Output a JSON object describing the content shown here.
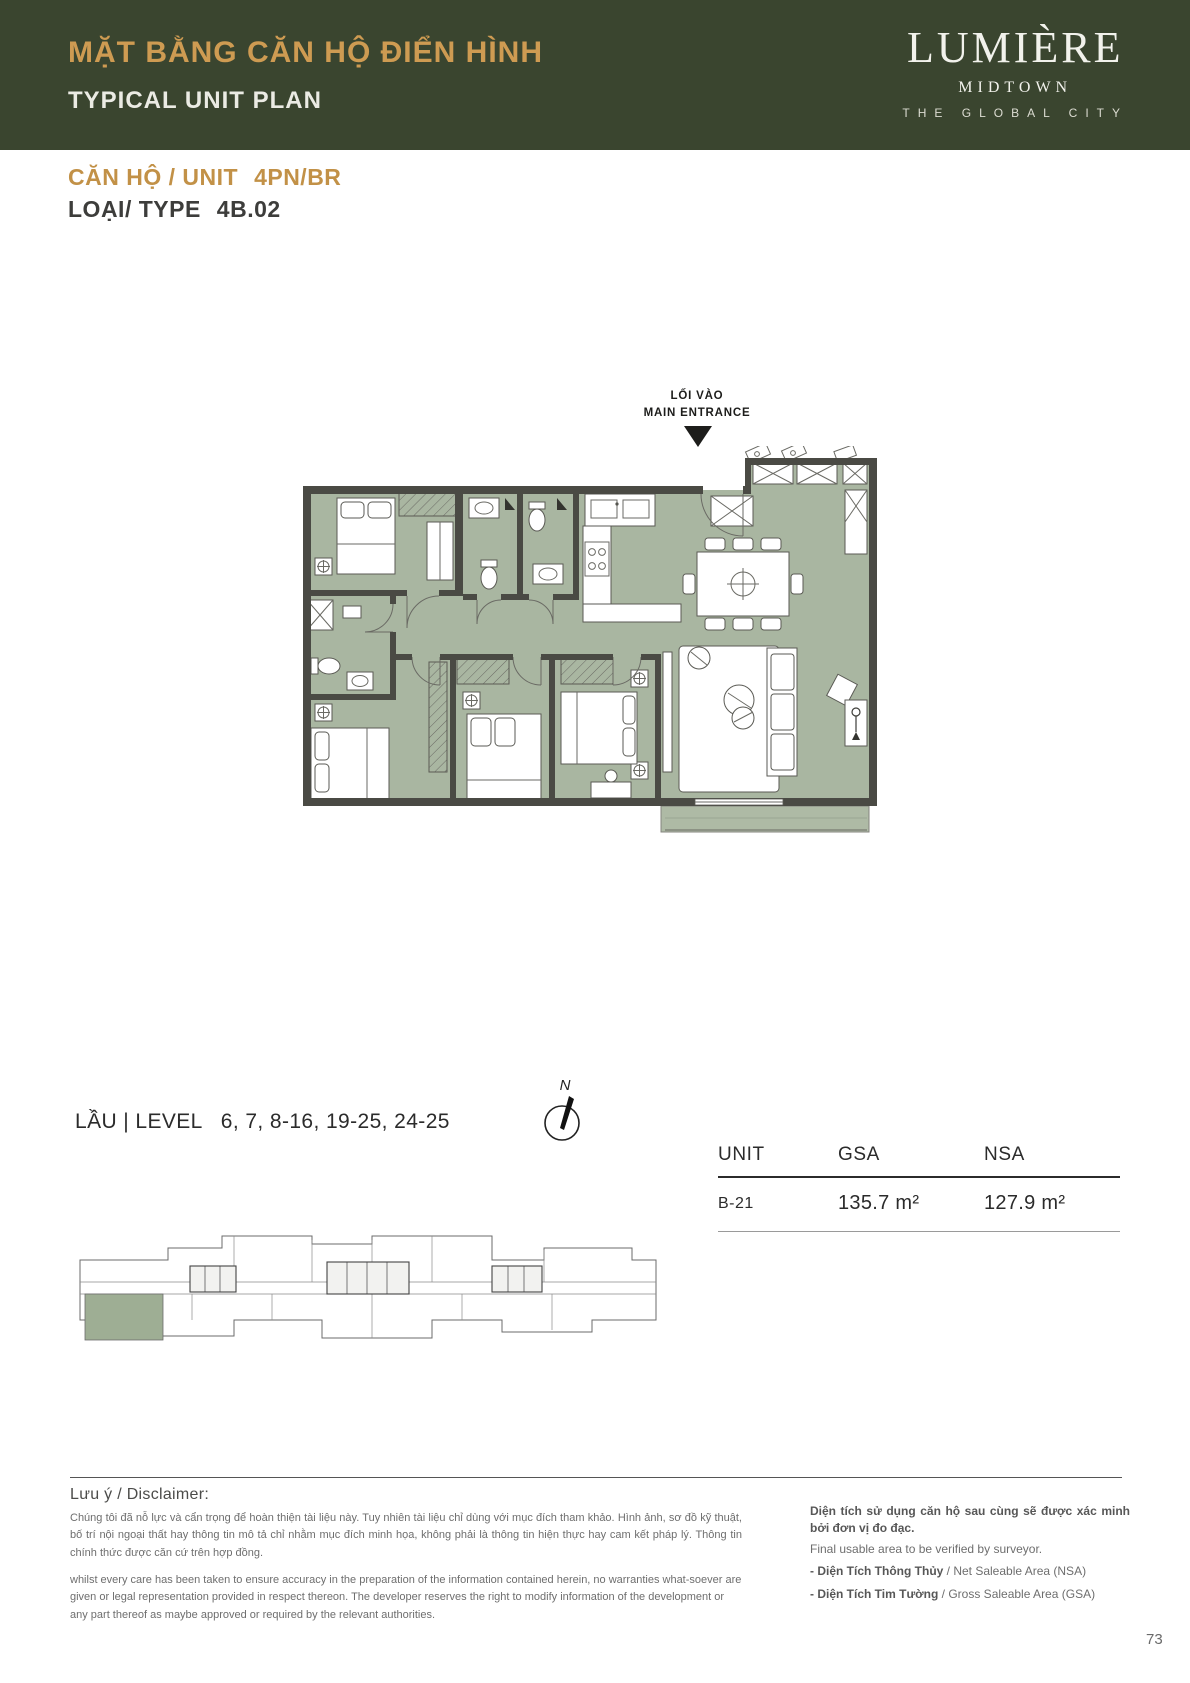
{
  "header": {
    "title_vi": "MẶT BẰNG CĂN HỘ ĐIỂN HÌNH",
    "title_en": "TYPICAL UNIT PLAN",
    "brand": {
      "name": "LUMIÈRE",
      "sub": "MIDTOWN",
      "tagline": "THE GLOBAL CITY"
    },
    "colors": {
      "banner_bg": "#3A452F",
      "accent_gold": "#CE9B52"
    }
  },
  "unit_info": {
    "unit_label": "CĂN HỘ / UNIT",
    "unit_value": "4PN/BR",
    "type_label": "LOẠI/ TYPE",
    "type_value": "4B.02"
  },
  "floor_plan": {
    "entrance_label_vi": "LỐI VÀO",
    "entrance_label_en": "MAIN ENTRANCE",
    "colors": {
      "room_fill": "#A9B6A1",
      "wall": "#4A4A44"
    }
  },
  "level_info": {
    "label": "LẦU | LEVEL",
    "values": "6, 7, 8-16, 19-25, 24-25"
  },
  "compass": {
    "label": "N"
  },
  "area_table": {
    "columns": [
      "UNIT",
      "GSA",
      "NSA"
    ],
    "rows": [
      {
        "unit": "B-21",
        "gsa": "135.7 m²",
        "nsa": "127.9 m²"
      }
    ]
  },
  "key_plan": {
    "highlight_color": "#9EAE94"
  },
  "disclaimer": {
    "heading": "Lưu ý / Disclaimer:",
    "vi": "Chúng tôi đã nỗ lực và cẩn trọng để hoàn thiện tài liệu này. Tuy nhiên tài liệu chỉ dùng với mục đích tham khảo. Hình ảnh, sơ đồ kỹ thuật, bố trí nội ngoại thất hay thông tin mô tả chỉ nhằm mục đích minh họa, không phải là thông tin hiện thực hay cam kết pháp lý. Thông tin chính thức được căn cứ trên hợp đồng.",
    "en": "whilst every care has been taken to ensure accuracy in the preparation of the information contained herein, no warranties what-soever are given or legal representation provided in respect thereon. The developer reserves the right to modify information of the development or any part thereof as maybe approved or required by the relevant authorities."
  },
  "area_notes": {
    "vi_bold": "Diện tích sử dụng căn hộ sau cùng sẽ được xác minh bởi đơn vị đo đạc.",
    "en": "Final usable area to be verified by surveyor.",
    "items": [
      {
        "bold": "-  Diện Tích Thông Thủy",
        "rest": " / Net Saleable Area (NSA)"
      },
      {
        "bold": "-  Diện Tích Tim Tường",
        "rest": " / Gross Saleable Area (GSA)"
      }
    ]
  },
  "page": {
    "number": "73"
  }
}
